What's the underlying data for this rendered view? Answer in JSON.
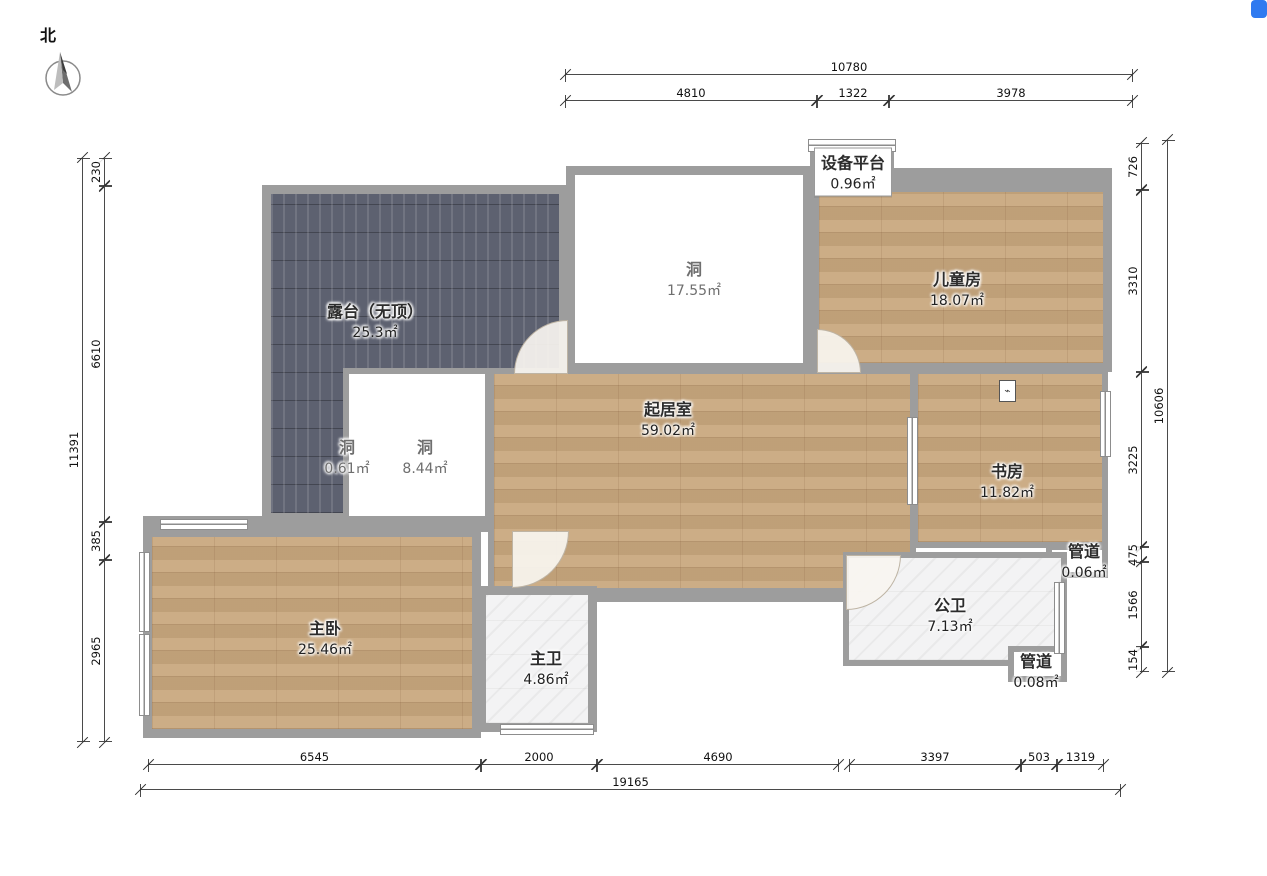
{
  "compass": {
    "label": "北"
  },
  "rooms": {
    "terrace": {
      "name": "露台（无顶）",
      "area": "25.3㎡"
    },
    "hole_large": {
      "name": "洞",
      "area": "17.55㎡"
    },
    "equipment_platform": {
      "name": "设备平台",
      "area": "0.96㎡"
    },
    "kids_room": {
      "name": "儿童房",
      "area": "18.07㎡"
    },
    "living_room": {
      "name": "起居室",
      "area": "59.02㎡"
    },
    "hole_mid": {
      "name": "洞",
      "area": "8.44㎡"
    },
    "hole_small": {
      "name": "洞",
      "area": "0.61㎡"
    },
    "study": {
      "name": "书房",
      "area": "11.82㎡"
    },
    "duct_top": {
      "name": "管道",
      "area": "0.06㎡"
    },
    "master_bedroom": {
      "name": "主卧",
      "area": "25.46㎡"
    },
    "master_bath": {
      "name": "主卫",
      "area": "4.86㎡"
    },
    "public_bath": {
      "name": "公卫",
      "area": "7.13㎡"
    },
    "duct_bottom": {
      "name": "管道",
      "area": "0.08㎡"
    }
  },
  "dimensions": {
    "top": {
      "total": "10780",
      "segments": [
        "4810",
        "1322",
        "3978"
      ]
    },
    "bottom": {
      "total": "19165",
      "segments": [
        "6545",
        "2000",
        "4690",
        "3397",
        "503",
        "1319"
      ]
    },
    "left": {
      "total": "11391",
      "segments": [
        "230",
        "6610",
        "385",
        "2965"
      ]
    },
    "right": {
      "total": "10606",
      "segments": [
        "726",
        "3310",
        "3225",
        "475",
        "1566",
        "154"
      ]
    }
  },
  "colors": {
    "wall": "#9d9d9d",
    "wood_floor": "#c9a87e",
    "terrace_floor": "#5d6170",
    "bath_floor": "#f3f3f4",
    "dimension_line": "#4a4a4a",
    "corner_icon": "#2f7af0"
  }
}
